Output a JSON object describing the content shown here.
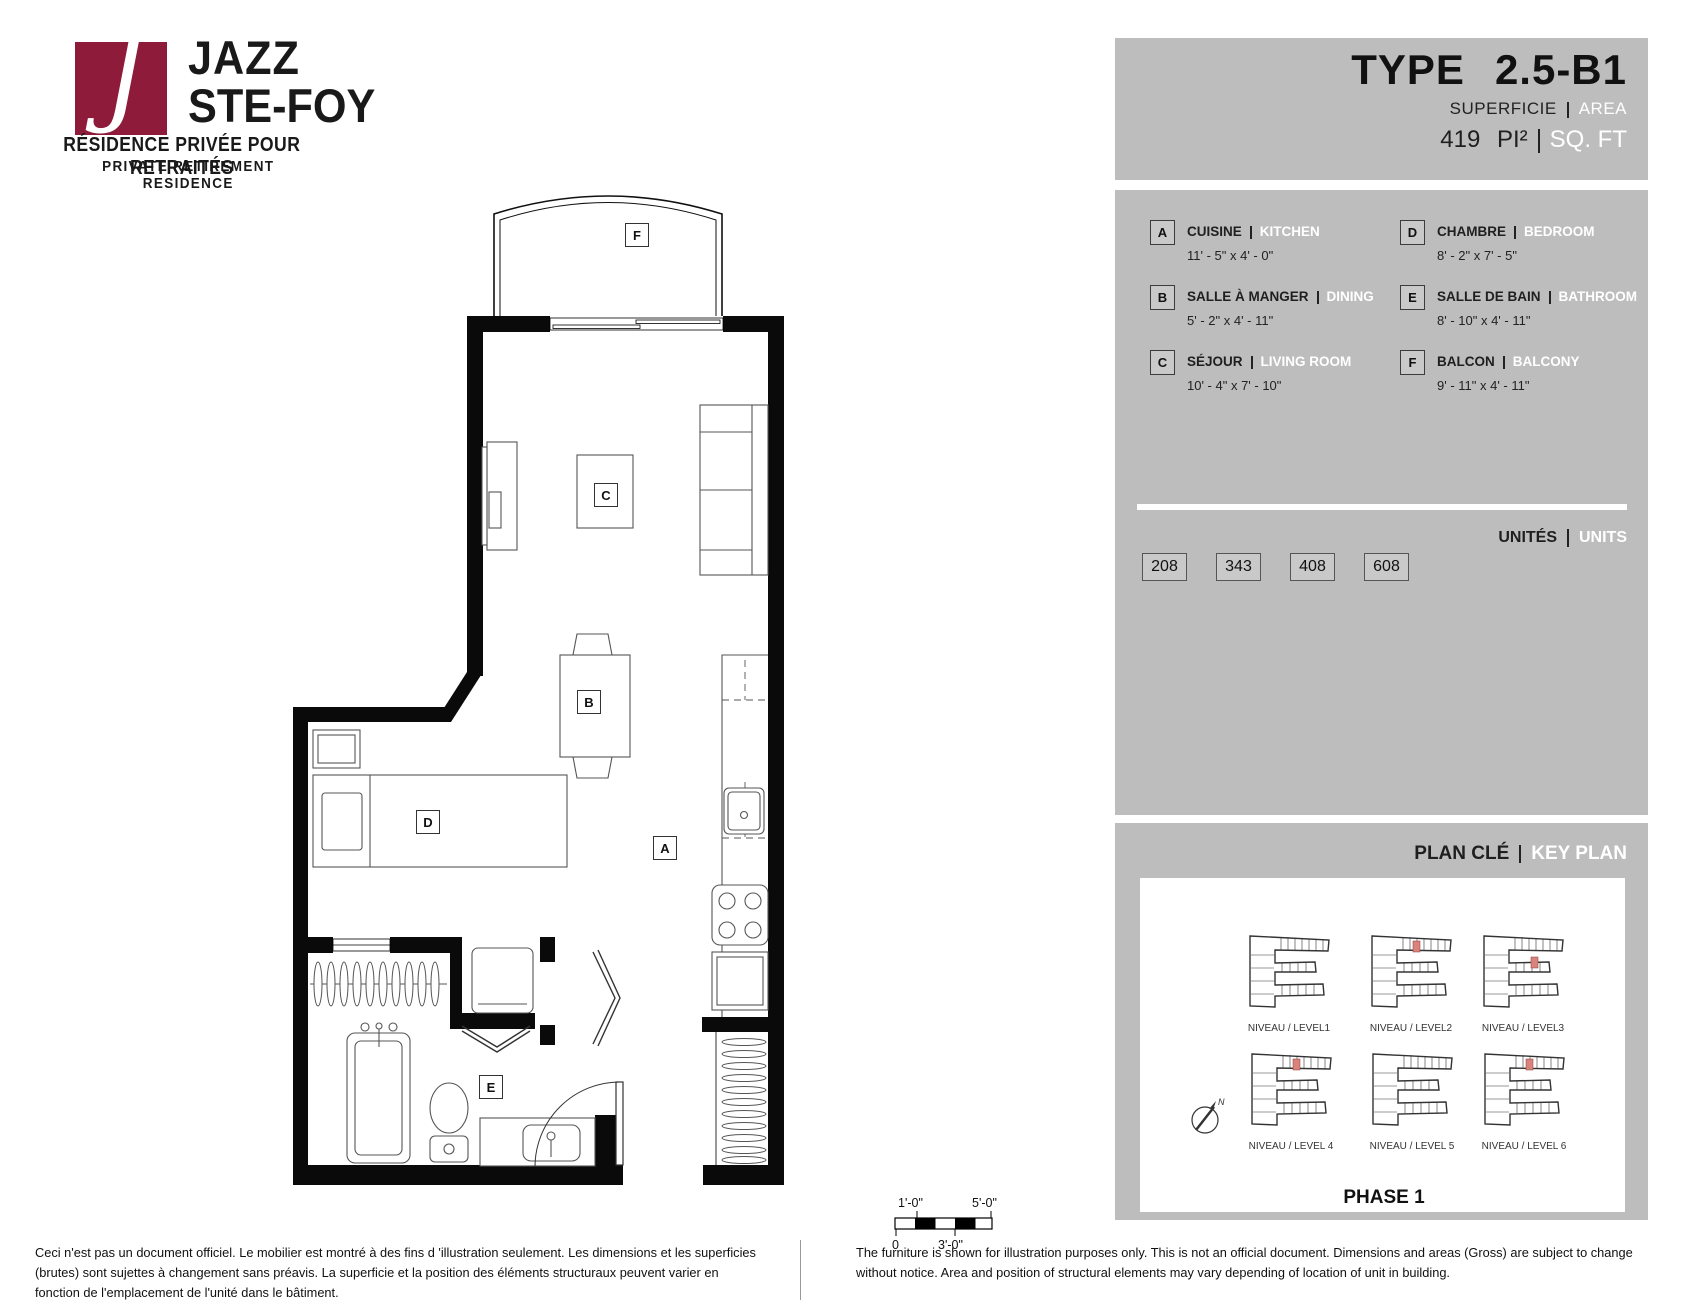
{
  "brand": {
    "monogram": "J",
    "name_line1": "JAZZ",
    "name_line2": "STE-FOY",
    "tagline_fr": "RÉSIDENCE PRIVÉE POUR RETRAITÉS",
    "tagline_en": "PRIVATE RETIREMENT RESIDENCE",
    "accent_color": "#8f1b3a"
  },
  "header": {
    "type_label": "TYPE",
    "type_value": "2.5-B1",
    "superficie_label": "SUPERFICIE",
    "area_label": "AREA",
    "area_value": "419",
    "area_unit_fr": "PI²",
    "area_unit_en": "SQ. FT"
  },
  "legend": {
    "rooms": [
      {
        "letter": "A",
        "name_fr": "CUISINE",
        "name_en": "KITCHEN",
        "dimensions": "11' - 5\" x 4' - 0\""
      },
      {
        "letter": "B",
        "name_fr": "SALLE À MANGER",
        "name_en": "DINING",
        "dimensions": "5' - 2\" x 4' - 11\""
      },
      {
        "letter": "C",
        "name_fr": "SÉJOUR",
        "name_en": "LIVING ROOM",
        "dimensions": "10' - 4\" x 7' - 10\""
      },
      {
        "letter": "D",
        "name_fr": "CHAMBRE",
        "name_en": "BEDROOM",
        "dimensions": "8' - 2\" x 7' - 5\""
      },
      {
        "letter": "E",
        "name_fr": "SALLE DE BAIN",
        "name_en": "BATHROOM",
        "dimensions": "8' - 10\" x 4' - 11\""
      },
      {
        "letter": "F",
        "name_fr": "BALCON",
        "name_en": "BALCONY",
        "dimensions": "9' - 11\" x 4' - 11\""
      }
    ]
  },
  "units": {
    "label_fr": "UNITÉS",
    "label_en": "UNITS",
    "numbers": [
      "208",
      "343",
      "408",
      "608"
    ]
  },
  "key_plan": {
    "label_fr": "PLAN CLÉ",
    "label_en": "KEY PLAN",
    "levels": [
      {
        "label": "NIVEAU / LEVEL1",
        "highlighted": false
      },
      {
        "label": "NIVEAU / LEVEL2",
        "highlighted": true
      },
      {
        "label": "NIVEAU / LEVEL3",
        "highlighted": true
      },
      {
        "label": "NIVEAU / LEVEL 4",
        "highlighted": true
      },
      {
        "label": "NIVEAU / LEVEL 5",
        "highlighted": false
      },
      {
        "label": "NIVEAU / LEVEL 6",
        "highlighted": true
      }
    ],
    "compass": "N",
    "phase": "PHASE 1",
    "highlight_color": "#d9837c"
  },
  "floor_plan": {
    "labels": {
      "kitchen": "A",
      "dining": "B",
      "living": "C",
      "bedroom": "D",
      "bathroom": "E",
      "balcony": "F"
    }
  },
  "scale_bar": {
    "top_left": "1'-0\"",
    "top_right": "5'-0\"",
    "bottom_left": "0",
    "bottom_center": "3'-0\""
  },
  "disclaimers": {
    "fr": "Ceci n'est pas un document officiel.  Le mobilier est montré à des fins d 'illustration seulement.  Les dimensions et les superficies (brutes) sont sujettes à changement sans préavis. La superficie et la position des éléments structuraux peuvent varier en fonction de l'emplacement de l'unité dans le bâtiment.",
    "en": "The furniture is shown for illustration purposes only.  This is not an official document.  Dimensions and areas (Gross) are subject to change without notice.  Area and position of structural elements may vary depending of location of unit in building."
  }
}
